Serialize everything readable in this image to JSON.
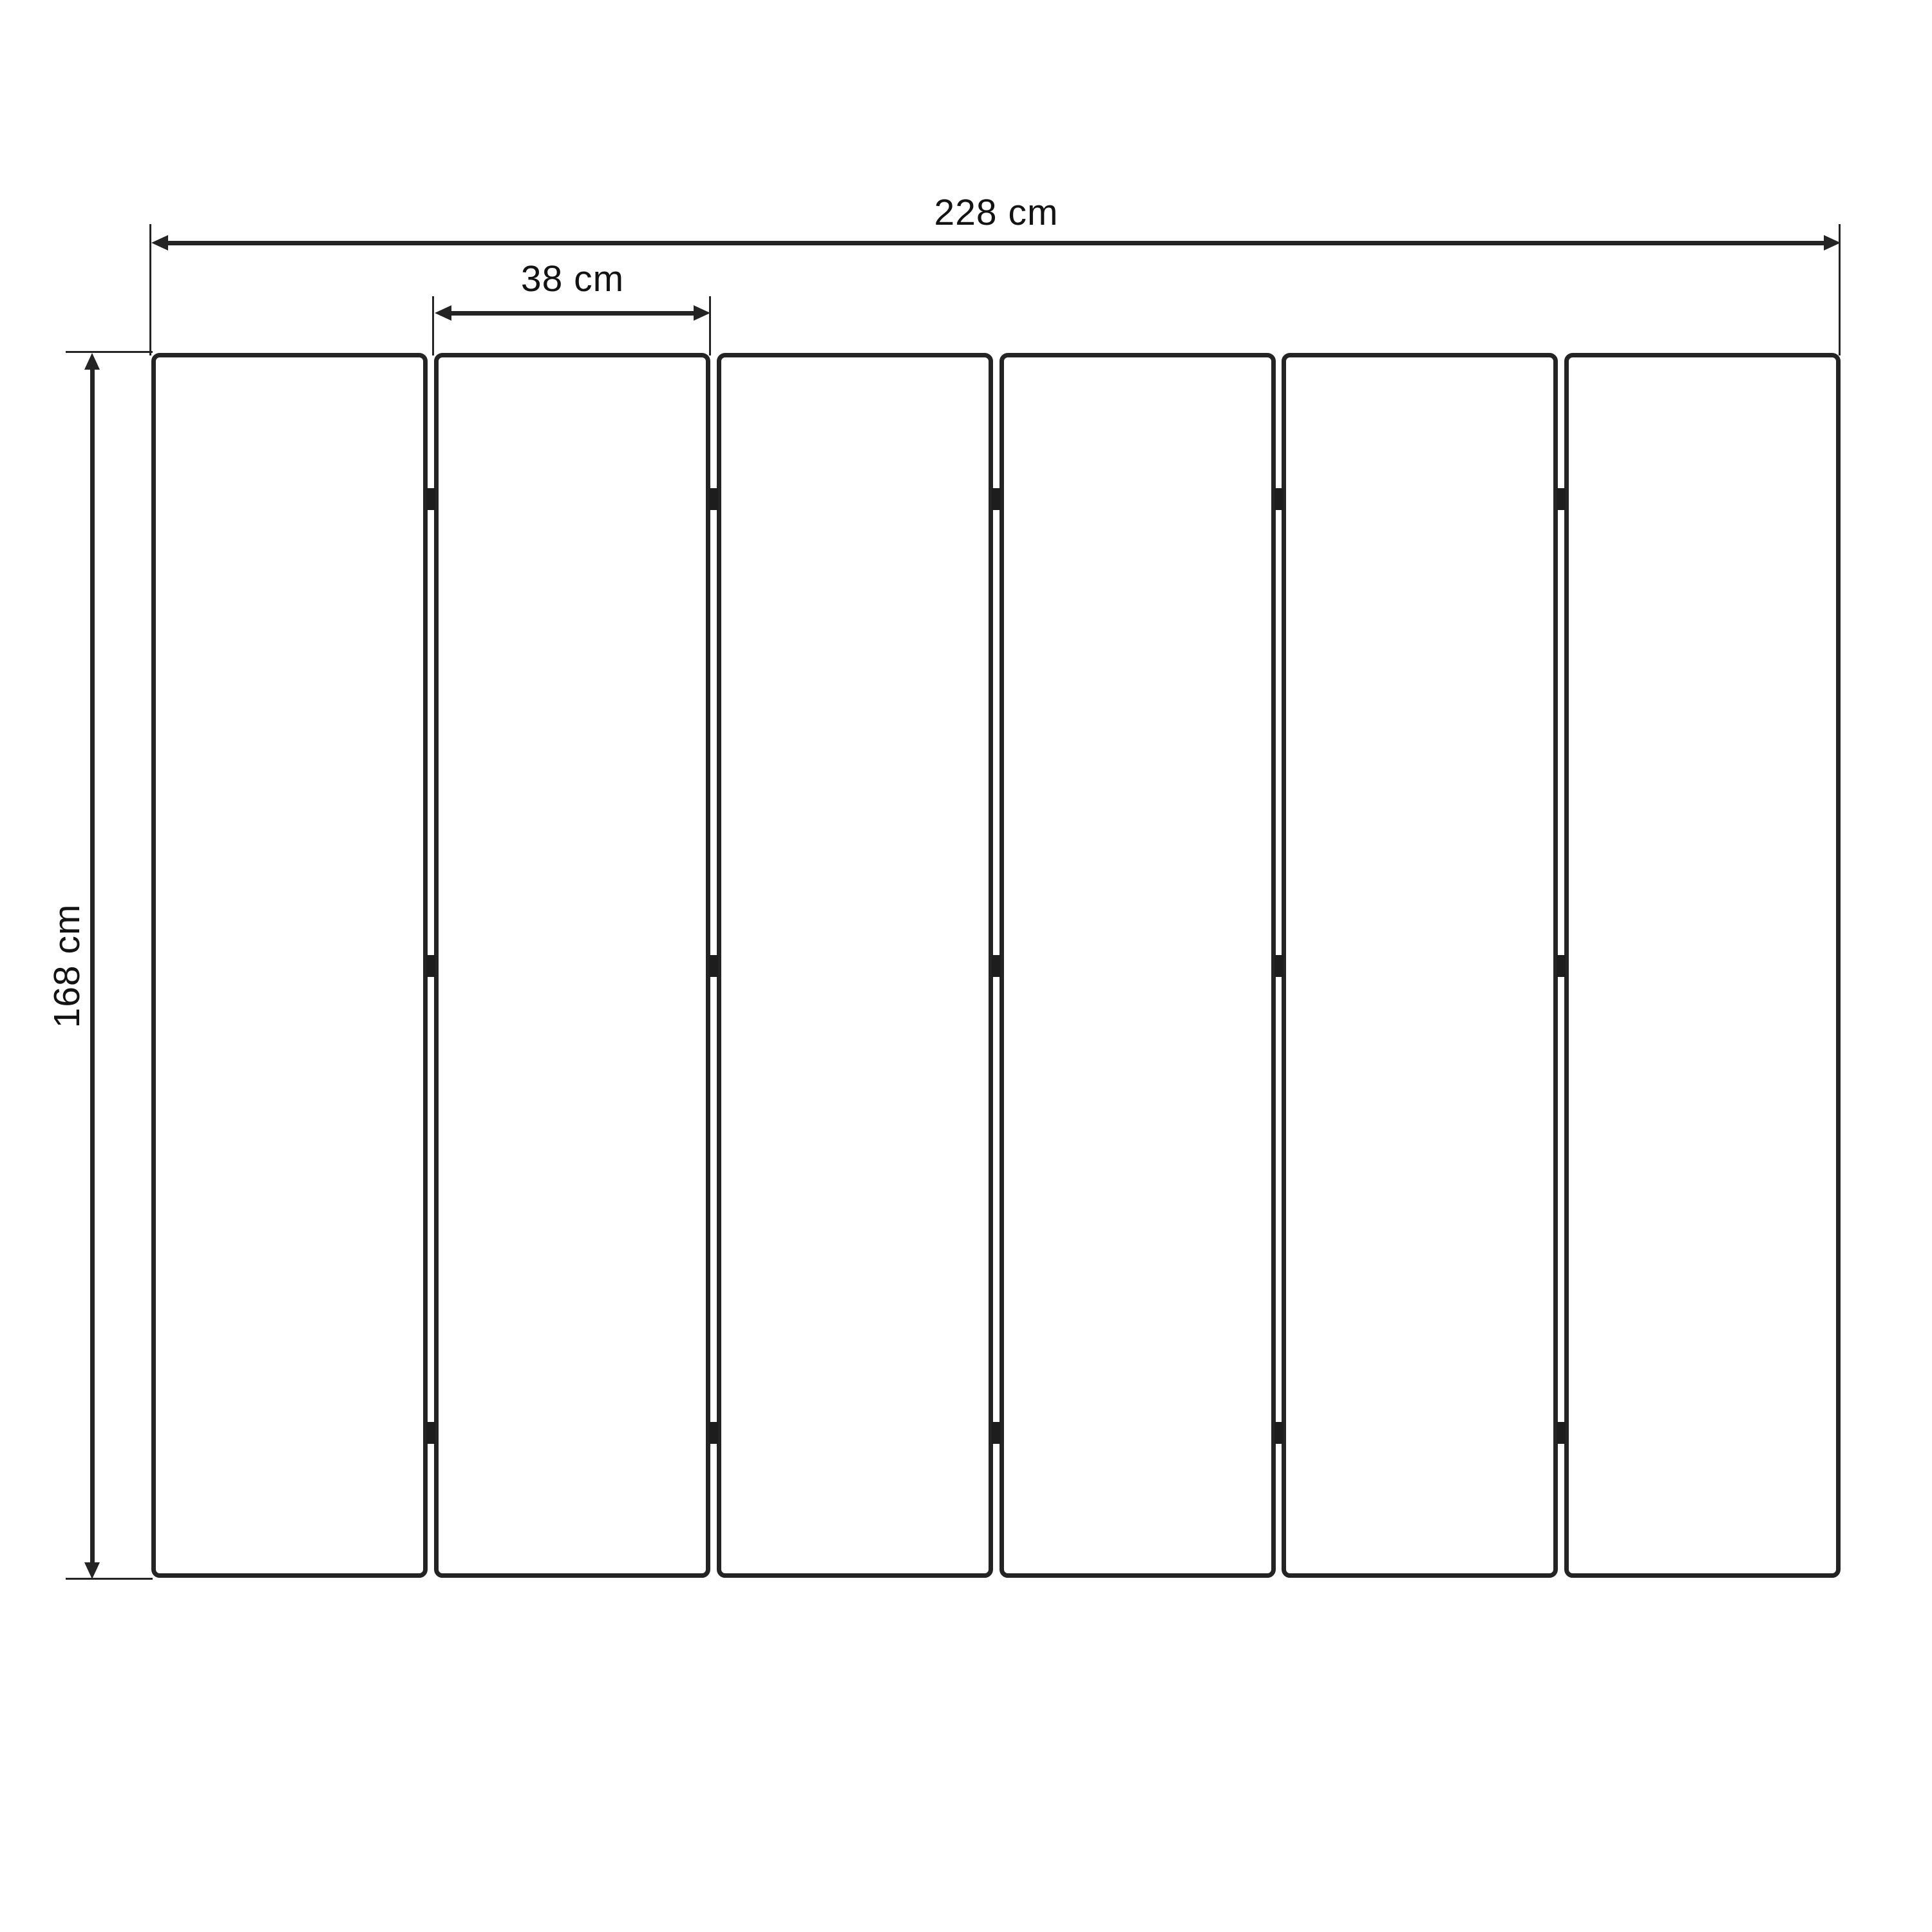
{
  "diagram": {
    "dimensions": {
      "total_width": {
        "label": "228 cm",
        "value_cm": 228
      },
      "panel_width": {
        "label": "38 cm",
        "value_cm": 38
      },
      "height": {
        "label": "168 cm",
        "value_cm": 168
      }
    },
    "panels": {
      "count": 6,
      "hinge_rows_per_gap": 3
    },
    "colors": {
      "line": "#242424",
      "text": "#131313",
      "background": "#ffffff"
    }
  }
}
